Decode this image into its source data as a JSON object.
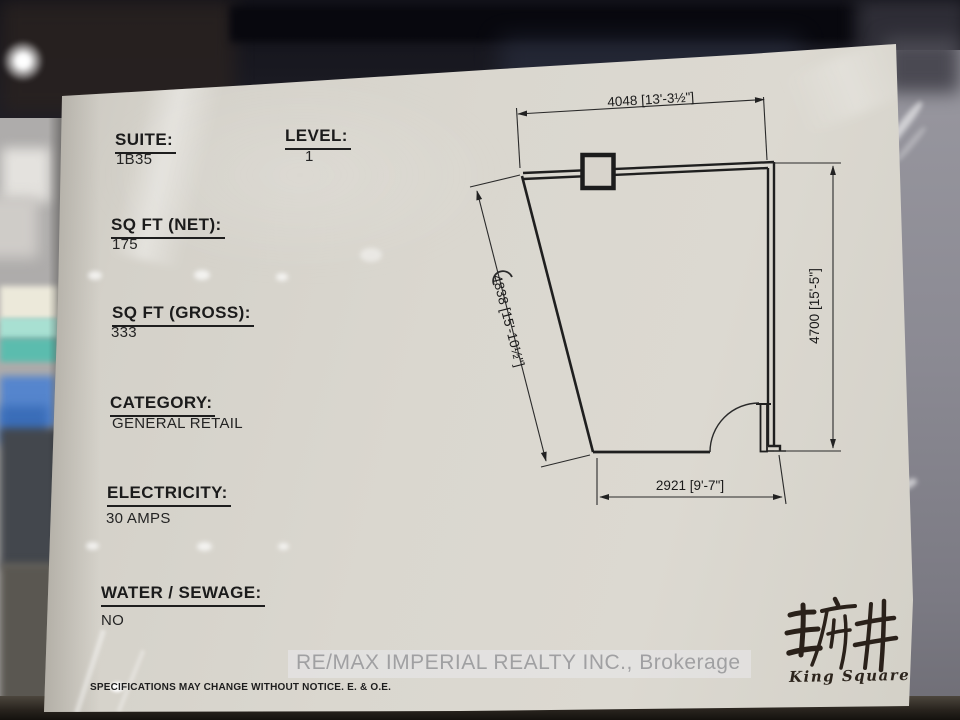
{
  "document": {
    "fields": [
      {
        "label": "SUITE:",
        "value": "1B35"
      },
      {
        "label": "LEVEL:",
        "value": "1"
      },
      {
        "label": "SQ FT (NET):",
        "value": "175"
      },
      {
        "label": "SQ FT (GROSS):",
        "value": "333"
      },
      {
        "label": "CATEGORY:",
        "value": "GENERAL RETAIL"
      },
      {
        "label": "ELECTRICITY:",
        "value": "30 AMPS"
      },
      {
        "label": "WATER / SEWAGE:",
        "value": "NO"
      }
    ],
    "watermark": "RE/MAX IMPERIAL REALTY INC., Brokerage",
    "disclaimer": "SPECIFICATIONS MAY CHANGE WITHOUT NOTICE. E. & O.E.",
    "logo": {
      "chinese": "王府井",
      "english": "King Square"
    }
  },
  "floor_plan": {
    "type": "retail-unit-outline",
    "dimensions": {
      "top": {
        "mm": "4048",
        "imperial": "13'-3½\"",
        "text": "4048 [13'-3½\"]"
      },
      "right": {
        "mm": "4700",
        "imperial": "15'-5\"",
        "text": "4700 [15'-5\"]"
      },
      "left": {
        "mm": "4838",
        "imperial": "15'-10½\"",
        "text": "4838 [15'-10½\"]"
      },
      "bottom": {
        "mm": "2921",
        "imperial": "9'-7\"",
        "text": "2921 [9'-7\"]"
      }
    },
    "features": [
      "column-at-top-wall",
      "entry-door-swing-bottom-right"
    ]
  },
  "colors": {
    "paper": "#d8d4cc",
    "plan_line": "#1f1f1f",
    "watermark_text": "#a0a0a2",
    "background_dark": "#14141a",
    "background_right_wall": "#8b8a93"
  }
}
